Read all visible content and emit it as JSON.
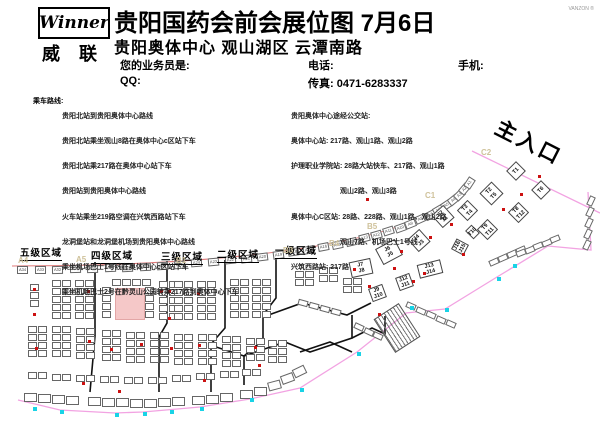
{
  "header": {
    "logo_text": "Winner",
    "logo_cn": "威 联",
    "title": "贵阳国药会前会展位图 7月6日",
    "subtitle": "贵阳奥体中心 观山湖区 云潭南路",
    "agent_label": "您的业务员是:",
    "qq_label": "QQ:",
    "phone_label": "电话:",
    "mobile_label": "手机:",
    "fax_label": "传真: 0471-6283337",
    "corner_mark": "VANZON ®"
  },
  "routes_left": {
    "label": "乘车路线:",
    "lines": [
      "贵阳北站到贵阳奥体中心路线",
      "贵阳北站乘坐观山8路在奥体中心c区站下车",
      "贵阳北站乘217路在奥体中心站下车",
      "贵阳站到贵阳奥体中心路线",
      "火车站乘坐219路空调在兴筑西路站下车",
      "龙洞堡站和龙洞堡机场到贵阳奥体中心路线",
      "乘坐机场巴士1号线在奥体中心c区站下车",
      "乘坐机场巴士2号在黔灵山公园转乘217路到奥体中心下车"
    ]
  },
  "routes_right": {
    "lines": [
      "贵阳奥体中心途经公交站:",
      "奥体中心站: 217路、观山1路、观山2路",
      "护理职业学院站: 28路大站快车、217路、观山1路",
      "　　　　　　　观山2路、观山3路",
      "奥体中心C区站: 28路、228路、观山1路、观山2路",
      "　　　　　　　观山7路、机场巴士1号线",
      "兴筑西路站: 217路"
    ]
  },
  "map": {
    "entrance_label": "主入口",
    "region_labels": [
      {
        "text": "五级区域",
        "x": 20,
        "y": 245
      },
      {
        "text": "四级区域",
        "x": 91,
        "y": 248
      },
      {
        "text": "三级区域",
        "x": 161,
        "y": 249
      },
      {
        "text": "二级区域",
        "x": 217,
        "y": 247
      },
      {
        "text": "一级区域",
        "x": 275,
        "y": 243
      }
    ],
    "zone_letters": [
      {
        "text": "A4",
        "x": 18,
        "y": 256
      },
      {
        "text": "A5",
        "x": 76,
        "y": 255
      },
      {
        "text": "B1",
        "x": 176,
        "y": 256
      },
      {
        "text": "B3",
        "x": 283,
        "y": 246
      },
      {
        "text": "B4",
        "x": 329,
        "y": 239
      },
      {
        "text": "B5",
        "x": 367,
        "y": 222
      },
      {
        "text": "C1",
        "x": 425,
        "y": 191
      },
      {
        "text": "C2",
        "x": 481,
        "y": 148
      }
    ],
    "curve_row": {
      "p": [
        [
          14,
          270
        ],
        [
          210,
          270
        ],
        [
          432,
          250
        ],
        [
          471,
          180
        ]
      ],
      "count": 34,
      "w": 11,
      "h": 8,
      "labels": [
        "A34",
        "A33",
        "A32",
        "A31",
        "A30",
        "A29",
        "A28",
        "A27",
        "A26",
        "A25",
        "A24",
        "A23",
        "A22",
        "A21",
        "A20",
        "A19",
        "A18",
        "A17",
        "A16",
        "A15",
        "A14",
        "A13",
        "A12",
        "A11",
        "A10",
        "A9",
        "A8",
        "A7",
        "A6",
        "A5",
        "A4",
        "A3",
        "A2",
        "A1"
      ]
    },
    "ladders": [
      [
        52,
        280,
        2,
        5
      ],
      [
        75,
        280,
        2,
        5
      ],
      [
        30,
        284,
        1,
        3
      ],
      [
        112,
        279,
        4,
        1
      ],
      [
        102,
        287,
        1,
        4
      ],
      [
        145,
        287,
        1,
        4
      ],
      [
        159,
        281,
        2,
        5
      ],
      [
        174,
        281,
        2,
        5
      ],
      [
        197,
        281,
        2,
        5
      ],
      [
        230,
        279,
        2,
        5
      ],
      [
        252,
        279,
        2,
        5
      ],
      [
        295,
        271,
        2,
        2
      ],
      [
        319,
        267,
        2,
        2
      ],
      [
        343,
        278,
        2,
        2
      ],
      [
        28,
        326,
        2,
        4
      ],
      [
        52,
        326,
        2,
        4
      ],
      [
        76,
        328,
        2,
        4
      ],
      [
        102,
        330,
        2,
        4
      ],
      [
        126,
        332,
        2,
        4
      ],
      [
        150,
        332,
        2,
        4
      ],
      [
        174,
        334,
        2,
        4
      ],
      [
        198,
        334,
        2,
        4
      ],
      [
        222,
        336,
        2,
        4
      ],
      [
        246,
        338,
        2,
        3
      ],
      [
        268,
        340,
        2,
        3
      ],
      [
        28,
        372,
        2,
        1
      ],
      [
        52,
        374,
        2,
        1
      ],
      [
        76,
        375,
        2,
        1
      ],
      [
        100,
        376,
        2,
        1
      ],
      [
        124,
        377,
        2,
        1
      ],
      [
        148,
        377,
        2,
        1
      ],
      [
        172,
        375,
        2,
        1
      ],
      [
        196,
        373,
        2,
        1
      ],
      [
        220,
        371,
        2,
        1
      ],
      [
        242,
        369,
        2,
        1
      ]
    ],
    "bottom_row": [
      [
        24,
        393
      ],
      [
        38,
        394
      ],
      [
        52,
        395
      ],
      [
        66,
        396
      ],
      [
        88,
        397
      ],
      [
        102,
        398
      ],
      [
        116,
        398
      ],
      [
        130,
        399
      ],
      [
        144,
        399
      ],
      [
        158,
        398
      ],
      [
        172,
        397
      ],
      [
        192,
        396
      ],
      [
        206,
        395
      ],
      [
        220,
        393
      ],
      [
        240,
        390
      ],
      [
        254,
        387
      ]
    ],
    "bottom_tail": [
      [
        268,
        381,
        -15
      ],
      [
        281,
        374,
        -20
      ],
      [
        293,
        367,
        -26
      ]
    ],
    "diag_rows": [
      {
        "x": 489,
        "y": 259,
        "dx": 9,
        "dy": -4,
        "rot": -24,
        "n": 4
      },
      {
        "x": 516,
        "y": 250,
        "dx": 8.5,
        "dy": -3.5,
        "rot": -22,
        "n": 5
      },
      {
        "x": 406,
        "y": 303,
        "dx": 10,
        "dy": 4.5,
        "rot": 24,
        "n": 5
      },
      {
        "x": 354,
        "y": 324,
        "dx": 9.5,
        "dy": 4.5,
        "rot": 25,
        "n": 3
      },
      {
        "x": 298,
        "y": 300,
        "dx": 11,
        "dy": 3,
        "rot": 15,
        "n": 4
      },
      {
        "x": 586,
        "y": 198,
        "dx": -1,
        "dy": 11,
        "rot": -65,
        "n": 5
      }
    ],
    "large_booths": [
      {
        "x": 443,
        "y": 216,
        "w": 16,
        "h": 17,
        "rot": -42,
        "lines": [
          "J2",
          "J1"
        ]
      },
      {
        "x": 419,
        "y": 240,
        "w": 16,
        "h": 17,
        "rot": -42,
        "lines": [
          "J4",
          "J3"
        ]
      },
      {
        "x": 389,
        "y": 252,
        "w": 22,
        "h": 18,
        "rot": -28,
        "lines": [
          "J6",
          "J5"
        ]
      },
      {
        "x": 361,
        "y": 268,
        "w": 22,
        "h": 16,
        "rot": -12,
        "lines": [
          "J7",
          "J8"
        ]
      },
      {
        "x": 377,
        "y": 293,
        "w": 15,
        "h": 14,
        "rot": -20,
        "lines": [
          "J9",
          "J10"
        ]
      },
      {
        "x": 404,
        "y": 282,
        "w": 15,
        "h": 14,
        "rot": -20,
        "lines": [
          "J12",
          "J11"
        ]
      },
      {
        "x": 430,
        "y": 269,
        "w": 24,
        "h": 14,
        "rot": -14,
        "lines": [
          "J13",
          "J14"
        ]
      },
      {
        "x": 460,
        "y": 247,
        "w": 12,
        "h": 14,
        "rot": -62,
        "lines": [
          "J16",
          "J15"
        ]
      },
      {
        "x": 467,
        "y": 210,
        "w": 15,
        "h": 15,
        "rot": -45,
        "lines": [
          "T3",
          "T4"
        ]
      },
      {
        "x": 491,
        "y": 193,
        "w": 17,
        "h": 17,
        "rot": -45,
        "lines": [
          "T2",
          "T5"
        ]
      },
      {
        "x": 516,
        "y": 171,
        "w": 14,
        "h": 14,
        "rot": -45,
        "lines": [
          "T1"
        ]
      },
      {
        "x": 541,
        "y": 190,
        "w": 14,
        "h": 14,
        "rot": -45,
        "lines": [
          "T6"
        ]
      },
      {
        "x": 518,
        "y": 212,
        "w": 15,
        "h": 15,
        "rot": -45,
        "lines": [
          "T8",
          "T12"
        ]
      },
      {
        "x": 487,
        "y": 229,
        "w": 15,
        "h": 15,
        "rot": -45,
        "lines": [
          "T9",
          "T11"
        ]
      },
      {
        "x": 472,
        "y": 232,
        "w": 9,
        "h": 12,
        "rot": -45,
        "lines": [
          "T10"
        ]
      }
    ],
    "pink_rect": {
      "x": 115,
      "y": 288,
      "w": 28,
      "h": 30
    },
    "stairs": {
      "x": 382,
      "y": 308,
      "w": 28,
      "h": 38,
      "rot": -33
    },
    "red_dots": [
      [
        33,
        288
      ],
      [
        33,
        313
      ],
      [
        87,
        290
      ],
      [
        160,
        290
      ],
      [
        168,
        290
      ],
      [
        168,
        317
      ],
      [
        197,
        292
      ],
      [
        35,
        347
      ],
      [
        88,
        340
      ],
      [
        110,
        348
      ],
      [
        140,
        343
      ],
      [
        170,
        347
      ],
      [
        198,
        344
      ],
      [
        254,
        346
      ],
      [
        258,
        364
      ],
      [
        82,
        382
      ],
      [
        118,
        390
      ],
      [
        203,
        379
      ],
      [
        353,
        268
      ],
      [
        366,
        198
      ],
      [
        378,
        313
      ],
      [
        393,
        267
      ],
      [
        400,
        250
      ],
      [
        412,
        280
      ],
      [
        423,
        272
      ],
      [
        450,
        223
      ],
      [
        462,
        253
      ],
      [
        502,
        208
      ],
      [
        520,
        193
      ],
      [
        538,
        175
      ],
      [
        368,
        285
      ],
      [
        429,
        236
      ]
    ],
    "cyan_dots": [
      [
        513,
        264
      ],
      [
        497,
        277
      ],
      [
        445,
        308
      ],
      [
        410,
        306
      ],
      [
        357,
        352
      ],
      [
        300,
        388
      ],
      [
        250,
        398
      ],
      [
        200,
        407
      ],
      [
        170,
        410
      ],
      [
        143,
        412
      ],
      [
        115,
        413
      ],
      [
        60,
        410
      ],
      [
        33,
        407
      ]
    ],
    "lines": {
      "red_curve": "M 12,266 C 210,266 432,248 471,180",
      "pink": [
        "472,151 600,213",
        "588,192 591,250 548,246 497,277 445,309 406,313 357,352 300,388 250,399 200,407 143,412 115,413 60,410 18,400"
      ],
      "black": [
        "95,262 95,336 90,392",
        "167,261 167,323 159,337 159,392",
        "225,260 225,328 211,344 211,392",
        "276,258 276,298 263,315 263,340 244,356 244,385",
        "263,317 302,303 347,315 371,303",
        "244,356 285,342 310,352 352,338 352,315",
        "213,346 244,356",
        "352,338 372,328 385,334 385,316",
        "300,352 330,342 352,352"
      ]
    },
    "colors": {
      "red_line": "#e07878",
      "pink_line": "#f2a3e2",
      "booth_border": "#666666",
      "red_dot": "#cc1111",
      "cyan_dot": "#19d3e6",
      "pink_fill": "#f5c8c8",
      "zone_letter": "#cfc29b"
    }
  }
}
